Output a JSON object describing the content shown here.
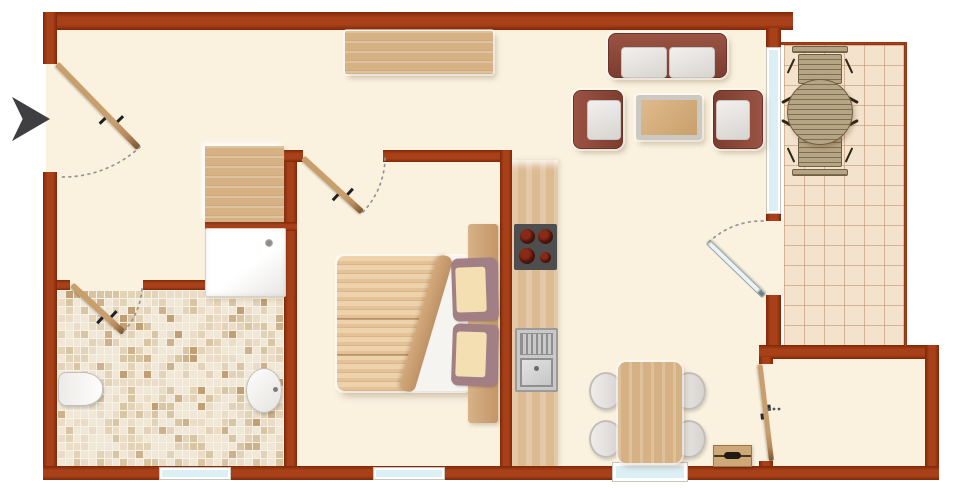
{
  "plan": {
    "kind": "apartment-floor-plan",
    "rooms_depicted": [
      "entrance-hall",
      "bathroom",
      "bedroom",
      "kitchen-living-dining",
      "balcony",
      "storage-room"
    ],
    "fixtures_depicted": [
      "entrance-arrow",
      "entrance-door",
      "wardrobe",
      "closet",
      "shower-tray",
      "toilet",
      "washbasin",
      "double-bed",
      "kitchen-counter",
      "stove",
      "sink",
      "dining-table",
      "dining-chairs",
      "sideboard",
      "sofa",
      "armchairs",
      "coffee-table",
      "balcony-table",
      "balcony-chairs",
      "windows",
      "door-swing-arcs"
    ]
  },
  "colors": {
    "outside": "#FFFFFF",
    "wall": "#A84019",
    "wall-dark": "#7E2807",
    "floor": "#FAF2DF",
    "glass": "#DCEFF4",
    "frame": "#FFFFFF",
    "wood": "#C99E6D",
    "wood-light": "#D6B184",
    "cushion": "#F2F0EE",
    "sofa": "#8E4B3C",
    "stove": "#4E4E4E",
    "burner": "#7B2113",
    "metal": "#9B9B9B",
    "tile": "#F3E2CC",
    "tile-line": "#C9A382",
    "grout": "#F8F2E6",
    "blanket": "#E8C9A0",
    "pillow-sham": "#A17F84",
    "pillow": "#F3DFB2",
    "arrow": "#3F3F41",
    "arc": "#979593"
  },
  "mosaic": {
    "shades": [
      "#F1E7D6",
      "#EADCC6",
      "#E2D2B8",
      "#D8C5A4",
      "#CCB18C",
      "#C19F75"
    ],
    "thresholds": [
      44,
      64,
      79,
      90,
      96,
      100
    ],
    "cols": 29,
    "rows": 22
  }
}
